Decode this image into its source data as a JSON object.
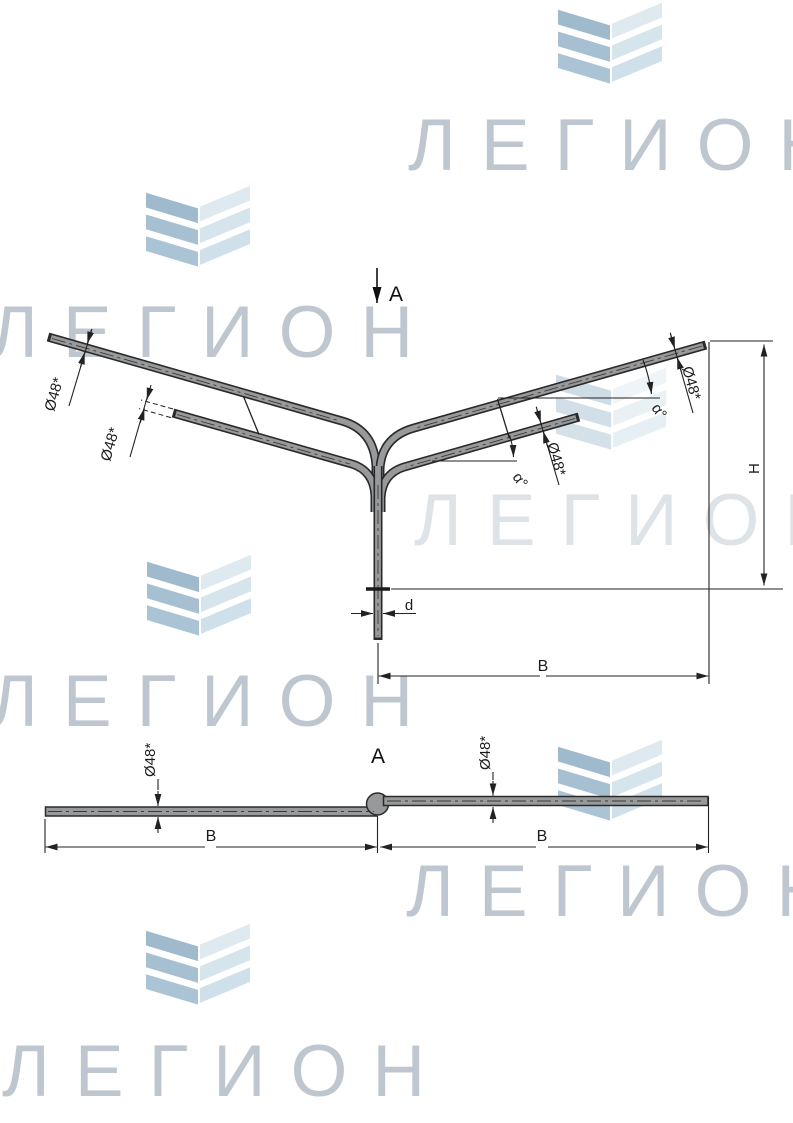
{
  "watermark": {
    "brand": "ЛЕГИОН"
  },
  "labels": {
    "diameter": "Ø48*",
    "angle": "α°",
    "height": "H",
    "reach": "B",
    "pipe_end": "d",
    "section": "A"
  },
  "colors": {
    "line": "#222222",
    "tube_fill": "#97999b",
    "watermark_text": "#b6c0ca",
    "chevron_left": "#a5bfd1",
    "chevron_right": "#d9e6ed"
  }
}
